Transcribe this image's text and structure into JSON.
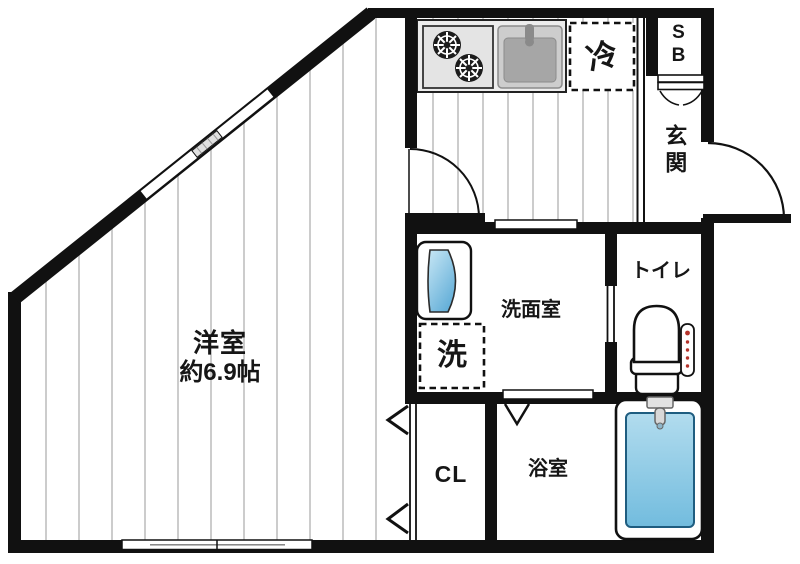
{
  "rooms": {
    "western_room": {
      "label": "洋室",
      "area": "約6.9帖"
    },
    "kitchen": {
      "refrigerator_label": "冷"
    },
    "shoe_box": {
      "label": "SB"
    },
    "entrance": {
      "label": "玄関"
    },
    "washroom": {
      "label": "洗面室",
      "washing_machine_label": "洗"
    },
    "toilet": {
      "label": "トイレ"
    },
    "closet": {
      "label": "CL"
    },
    "bathroom": {
      "label": "浴室"
    }
  },
  "colors": {
    "wall": "#111111",
    "floor_line": "#cccccc",
    "counter": "#ededed",
    "appliance": "#e4e4e4",
    "sink": "#a6a6a6",
    "water_light": "#c8e7f5",
    "water_dark": "#62aed8",
    "tub_light": "#b2dcee",
    "tub_dark": "#72bcde",
    "remote_red": "#b5342c",
    "text": "#161616"
  }
}
